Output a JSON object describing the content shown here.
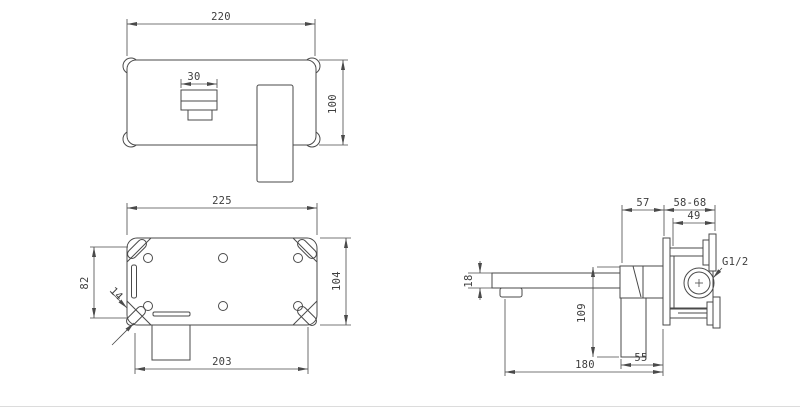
{
  "drawing": {
    "background": "#ffffff",
    "line_color": "#4a4a4a",
    "views": {
      "front": {
        "dim_width": "220",
        "dim_spout_width": "30",
        "dim_height": "100"
      },
      "back": {
        "dim_width": "225",
        "dim_slot_spacing": "82",
        "dim_height": "104",
        "dim_slot_width": "14",
        "dim_bottom_width": "203"
      },
      "side": {
        "dim_handle_to_wall": "57",
        "dim_wall_range": "58-68",
        "dim_inlet_depth": "49",
        "thread_label": "G1/2",
        "dim_spout_height": "18",
        "dim_body_height": "109",
        "dim_handle_depth": "55",
        "dim_spout_reach": "180"
      }
    }
  }
}
